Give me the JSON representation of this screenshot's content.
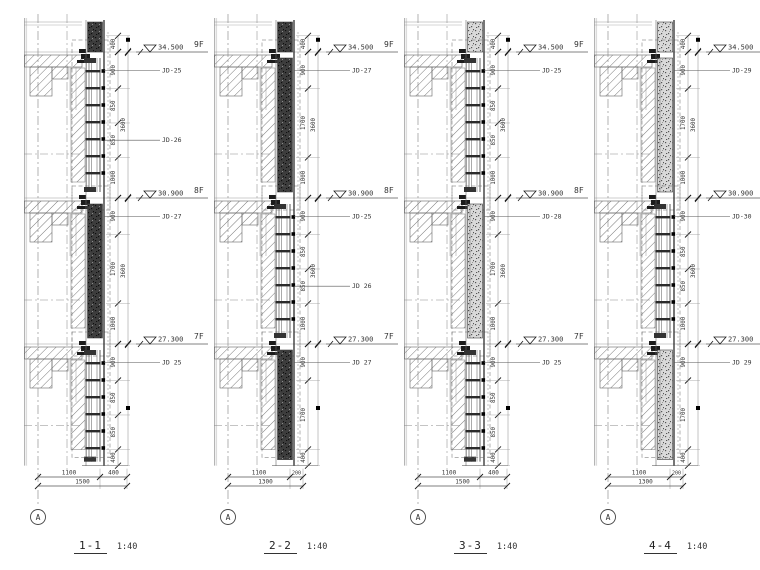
{
  "drawing": {
    "background": "#ffffff",
    "line_color": "#6a6a6a",
    "dark_color": "#1c1c1c",
    "text_color": "#333333",
    "hatch_color": "#7a7a7a"
  },
  "sections": [
    {
      "title": "1-1",
      "scale": "1:40",
      "grid_label": "A",
      "band_style": "dark",
      "top_dim": "400",
      "floors": [
        {
          "elevation": "34.500",
          "label": "9F"
        },
        {
          "elevation": "30.900",
          "label": "8F"
        },
        {
          "elevation": "27.300",
          "label": "7F"
        }
      ],
      "bays": [
        {
          "type": "window",
          "segments": [
            "900",
            "850",
            "850",
            "1000"
          ],
          "total": "3600",
          "jd_labels": [
            {
              "seg": 0,
              "text": "JD-25"
            },
            {
              "seg": 2,
              "text": "JD-26"
            }
          ]
        },
        {
          "type": "solid",
          "segments": [
            "900",
            "1700",
            "1000"
          ],
          "total": "3600",
          "jd_labels": [
            {
              "seg": 0,
              "text": "JD-27"
            }
          ]
        }
      ],
      "below": {
        "type": "window",
        "segments": [
          "900",
          "850",
          "850",
          "400"
        ],
        "jd_labels": [
          {
            "seg": 0,
            "text": "JD 25"
          }
        ]
      },
      "bottom_dims": {
        "segments": [
          "1100",
          "400"
        ],
        "total": "1500"
      }
    },
    {
      "title": "2-2",
      "scale": "1:40",
      "grid_label": "A",
      "band_style": "dark",
      "top_dim": "400",
      "floors": [
        {
          "elevation": "34.500",
          "label": "9F"
        },
        {
          "elevation": "30.900",
          "label": "8F"
        },
        {
          "elevation": "27.300",
          "label": "7F"
        }
      ],
      "bays": [
        {
          "type": "solid",
          "segments": [
            "900",
            "1700",
            "1000"
          ],
          "total": "3600",
          "jd_labels": [
            {
              "seg": 0,
              "text": "JD-27"
            }
          ]
        },
        {
          "type": "window",
          "segments": [
            "900",
            "850",
            "850",
            "1000"
          ],
          "total": "3600",
          "jd_labels": [
            {
              "seg": 0,
              "text": "JD-25"
            },
            {
              "seg": 2,
              "text": "JD 26"
            }
          ]
        }
      ],
      "below": {
        "type": "solid",
        "segments": [
          "900",
          "1700",
          "400"
        ],
        "jd_labels": [
          {
            "seg": 0,
            "text": "JD 27"
          }
        ]
      },
      "bottom_dims": {
        "segments": [
          "1100",
          "200"
        ],
        "total": "1300"
      }
    },
    {
      "title": "3-3",
      "scale": "1:40",
      "grid_label": "A",
      "band_style": "stone",
      "top_dim": "400",
      "floors": [
        {
          "elevation": "34.500",
          "label": "9F"
        },
        {
          "elevation": "30.900",
          "label": "8F"
        },
        {
          "elevation": "27.300",
          "label": "7F"
        }
      ],
      "bays": [
        {
          "type": "window",
          "segments": [
            "900",
            "850",
            "850",
            "1000"
          ],
          "total": "3600",
          "jd_labels": [
            {
              "seg": 0,
              "text": "JD-25"
            }
          ]
        },
        {
          "type": "solid",
          "segments": [
            "900",
            "1700",
            "1000"
          ],
          "total": "3600",
          "jd_labels": [
            {
              "seg": 0,
              "text": "JD-28"
            }
          ]
        }
      ],
      "below": {
        "type": "window",
        "segments": [
          "900",
          "850",
          "850",
          "400"
        ],
        "jd_labels": [
          {
            "seg": 0,
            "text": "JD 25"
          }
        ]
      },
      "bottom_dims": {
        "segments": [
          "1100",
          "400"
        ],
        "total": "1500"
      }
    },
    {
      "title": "4-4",
      "scale": "1:40",
      "grid_label": "A",
      "band_style": "stone",
      "top_dim": "400",
      "floors": [
        {
          "elevation": "34.500",
          "label": "9F"
        },
        {
          "elevation": "30.900",
          "label": "8F"
        },
        {
          "elevation": "27.300",
          "label": "7F"
        }
      ],
      "bays": [
        {
          "type": "solid",
          "segments": [
            "900",
            "1700",
            "1000"
          ],
          "total": "3600",
          "jd_labels": [
            {
              "seg": 0,
              "text": "JD-29"
            }
          ]
        },
        {
          "type": "window",
          "segments": [
            "900",
            "850",
            "850",
            "1000"
          ],
          "total": "3600",
          "jd_labels": [
            {
              "seg": 0,
              "text": "JD-30"
            }
          ]
        }
      ],
      "below": {
        "type": "solid",
        "segments": [
          "900",
          "1700",
          "400"
        ],
        "jd_labels": [
          {
            "seg": 0,
            "text": "JD 29"
          }
        ]
      },
      "bottom_dims": {
        "segments": [
          "1100",
          "200"
        ],
        "total": "1300"
      }
    }
  ]
}
